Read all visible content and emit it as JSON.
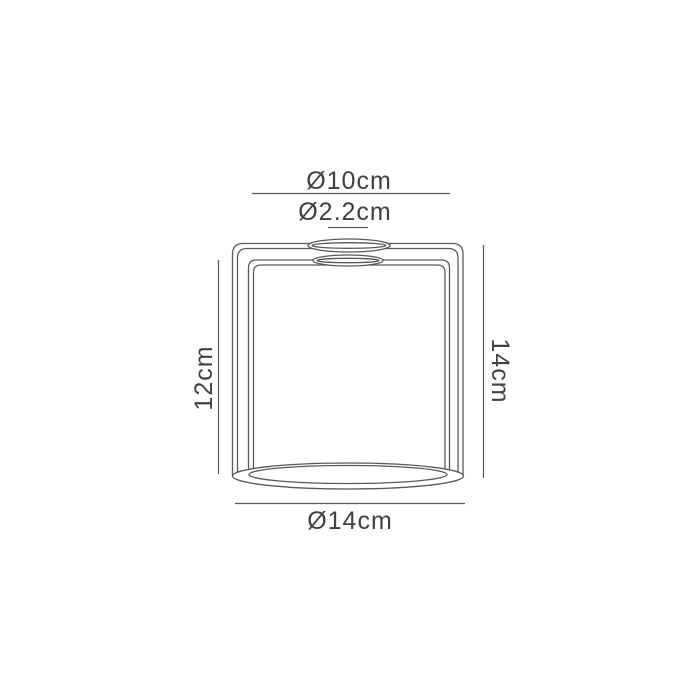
{
  "diagram": {
    "labels": {
      "top_ring_diameter": "Ø10cm",
      "fitting_hole_diameter": "Ø2.2cm",
      "inner_height": "12cm",
      "overall_height": "14cm",
      "base_diameter": "Ø14cm"
    },
    "colors": {
      "line": "#58595b",
      "text": "#414042",
      "background": "#ffffff"
    }
  }
}
